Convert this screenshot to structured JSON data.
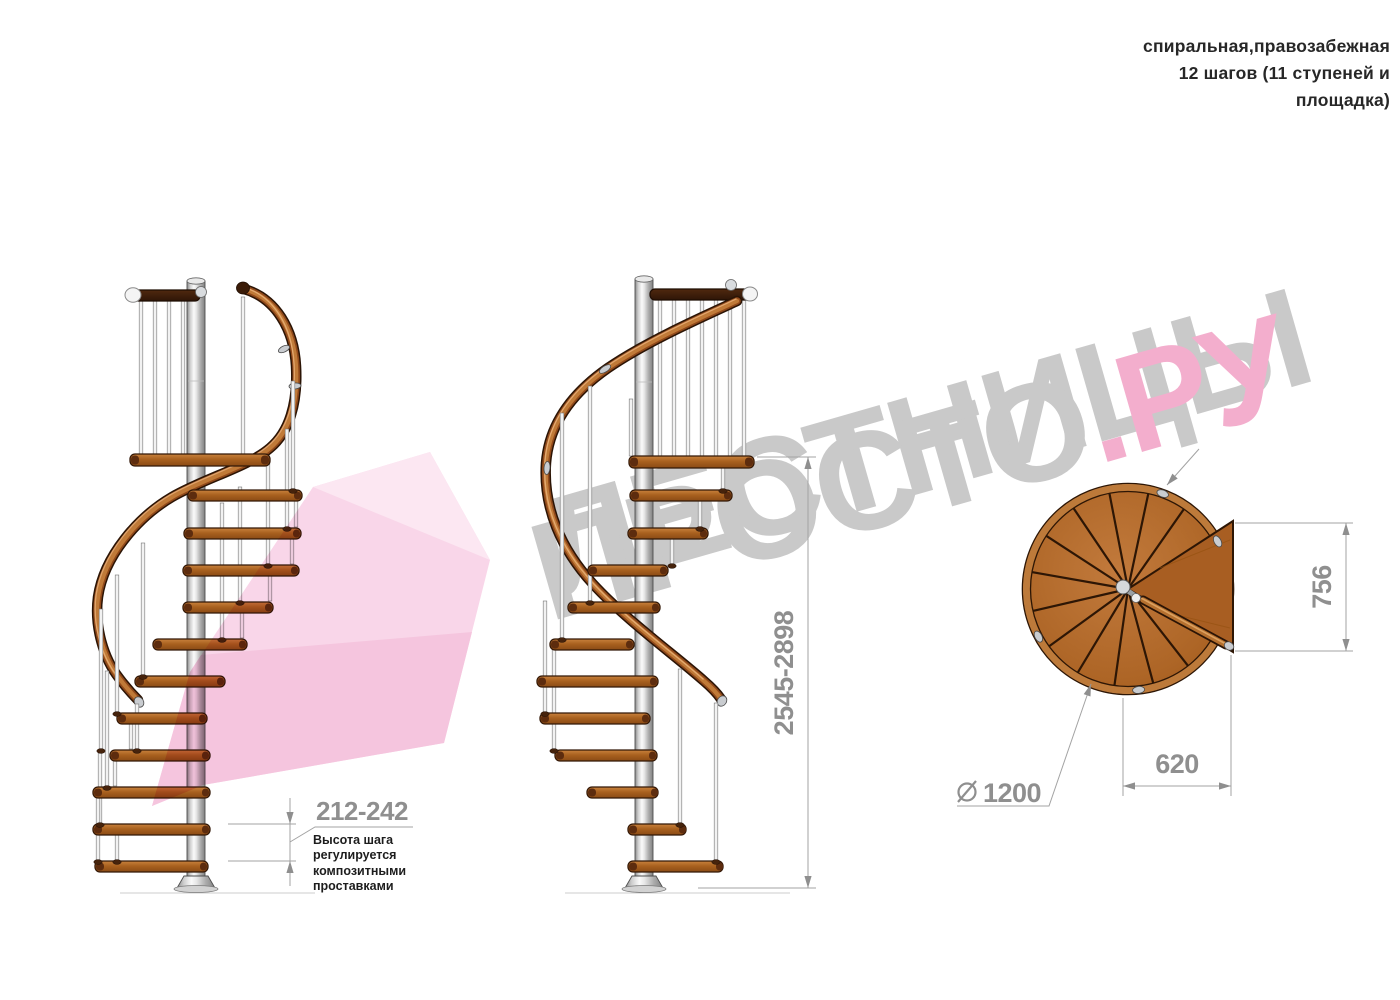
{
  "header": {
    "lines": [
      "спиральная,правозабежная",
      "12 шагов (11 ступеней и",
      "площадка)"
    ]
  },
  "watermark": {
    "line1": "ЛЕСТНИЦЫ",
    "line2_gray": "ПРОСТО",
    "line2_pink": ".РУ",
    "gray_color": "#c9c9c9",
    "pink_color": "#f3aecd",
    "arrow_pink": "#f8cfe5"
  },
  "dims": {
    "step_height": "212-242",
    "total_height": "2545-2898",
    "landing_depth": "756",
    "landing_width": "620",
    "diameter": "1200",
    "diameter_symbol": "⌀"
  },
  "note": {
    "lines": [
      "Высота шага",
      "регулируется",
      "композитными",
      "проставками"
    ]
  },
  "drawing": {
    "subject": "spiral staircase, 3 views",
    "colors": {
      "wood": "#a9611f",
      "handrail": "#91491a",
      "metal_pole": "#d9d9d9",
      "dimension_gray": "#8f8f8f",
      "note_text": "#1d1d1d"
    }
  }
}
